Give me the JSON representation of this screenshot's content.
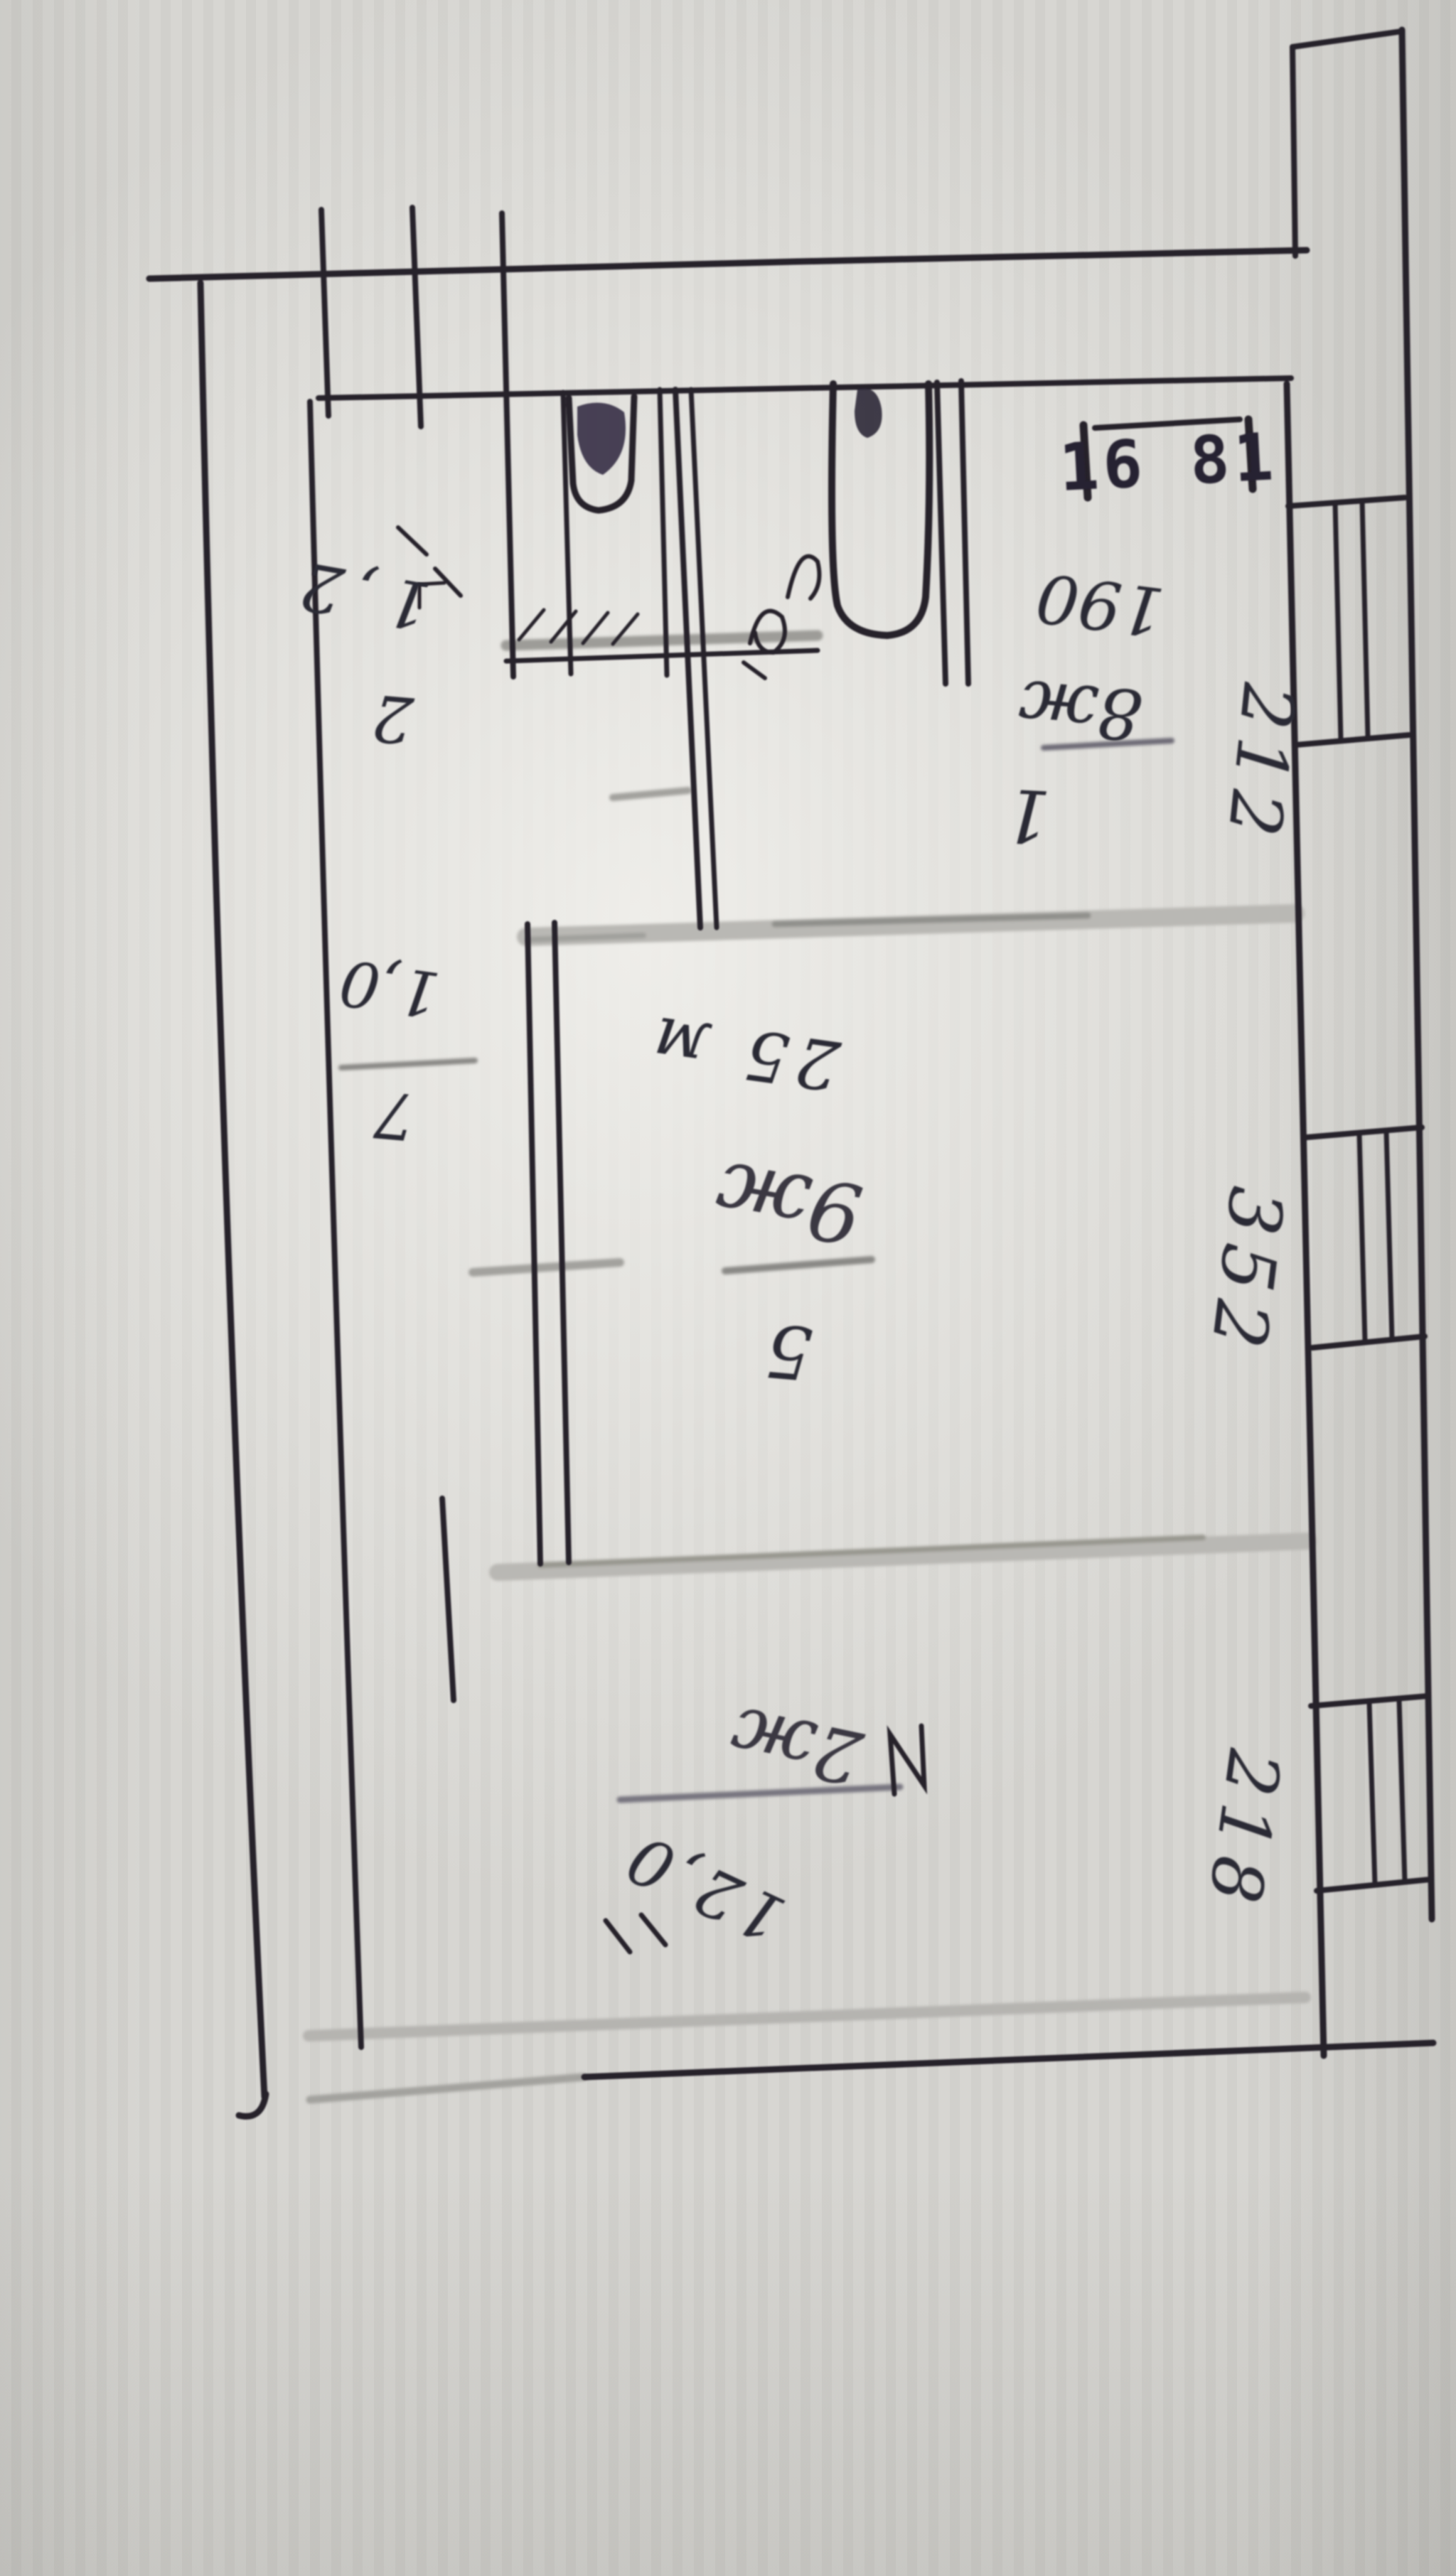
{
  "colors": {
    "paper": "#d5d4d0",
    "ink": "#27242c",
    "pencil_light": "#b6b5b1",
    "pencil_dark": "#8f8e8a",
    "handwriting": "#2c2a35"
  },
  "stamp": {
    "text": "16 81"
  },
  "rooms": {
    "room_1": {
      "number": "1",
      "width_label": "190",
      "area_label": "8ж"
    },
    "room_2": {
      "number": "2",
      "area_label": "1,2"
    },
    "closet": {
      "number": "7",
      "area_label": "1,0"
    },
    "room_5": {
      "number": "5",
      "area_label": "9ж",
      "size_label": "25 м"
    },
    "room_bottom": {
      "area_label": "2ж",
      "size_label": "12,0"
    }
  },
  "wall_dimensions": {
    "upper_right": "212",
    "middle_right": "352",
    "lower_right": "218"
  }
}
